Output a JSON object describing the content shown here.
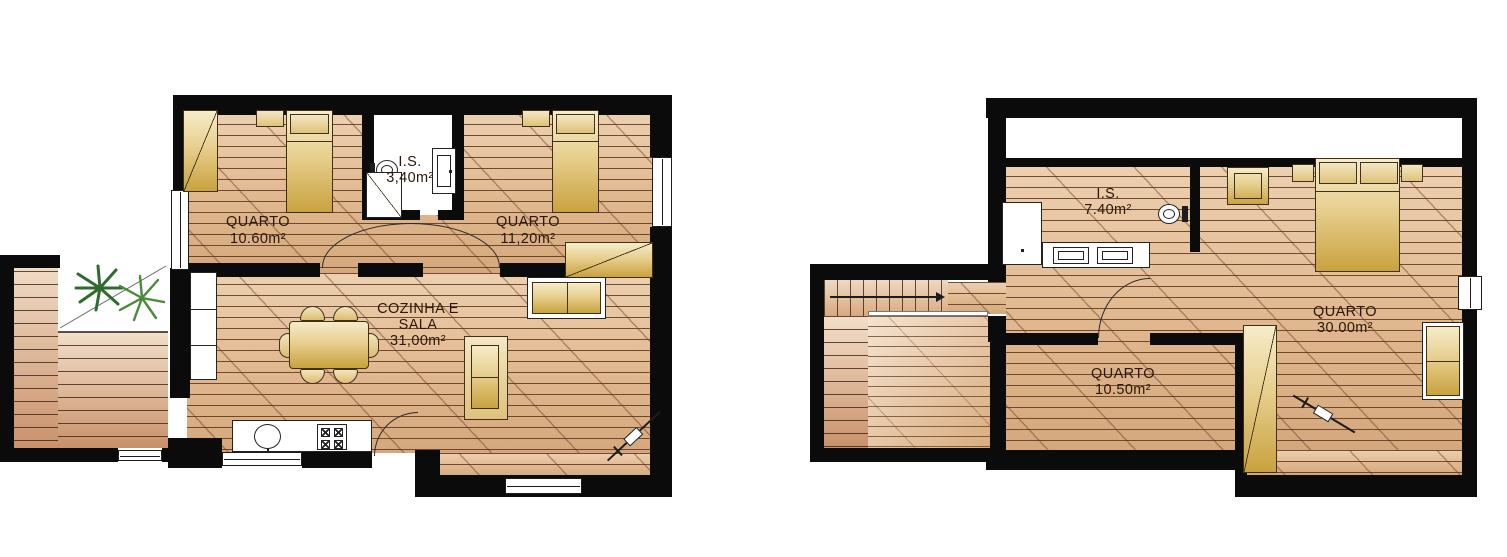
{
  "ground": {
    "bedroom1": {
      "name": "QUARTO",
      "area": "10.60m²"
    },
    "bathroom": {
      "name": "I.S.",
      "area": "3,40m²"
    },
    "bedroom2": {
      "name": "QUARTO",
      "area": "11,20m²"
    },
    "living": {
      "name_line1": "COZINHA E",
      "name_line2": "SALA",
      "area": "31,00m²"
    }
  },
  "upper": {
    "bathroom": {
      "name": "I.S.",
      "area": "7.40m²"
    },
    "bedroom_main": {
      "name": "QUARTO",
      "area": "30.00m²"
    },
    "bedroom_small": {
      "name": "QUARTO",
      "area": "10.50m²"
    }
  },
  "colors": {
    "wall": "#0b0b0b",
    "floor_light": "#ecd0b0",
    "floor_dark": "#d4a87c",
    "furniture_gold": "#c9a23f",
    "plant_green": "#2f6b2f",
    "background": "#ffffff"
  }
}
